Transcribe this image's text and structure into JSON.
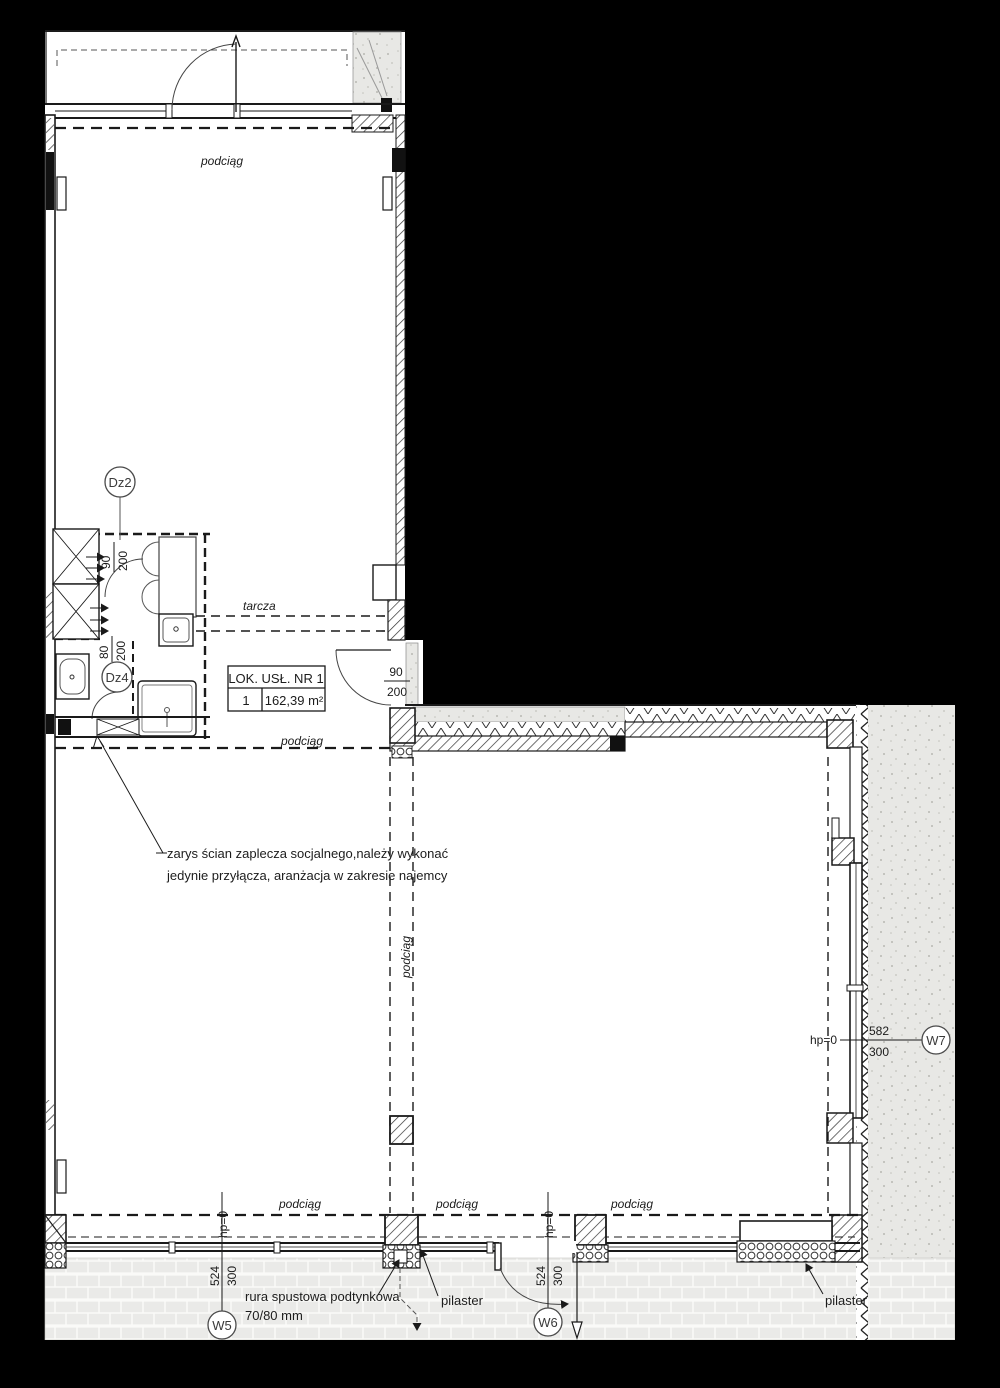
{
  "labels": {
    "podciag": "podciąg",
    "tarcza": "tarcza"
  },
  "room_table": {
    "title": "LOK. USŁ. NR 1",
    "index": "1",
    "area": "162,39 m²"
  },
  "markers": {
    "dz2": "Dz2",
    "dz4": "Dz4",
    "w5": "W5",
    "w6": "W6",
    "w7": "W7"
  },
  "dims": {
    "d90": "90",
    "d200": "200",
    "d80": "80",
    "hp0": "hp=0",
    "v524": "524",
    "v300": "300",
    "v582": "582"
  },
  "notes": {
    "outline1": "zarys ścian zaplecza socjalnego,należy wykonać",
    "outline2": "jedynie przyłącza, aranżacja w zakresie najemcy",
    "pipe1": "rura spustowa podtynkowa",
    "pipe2": "70/80 mm",
    "pilaster": "pilaster"
  },
  "colors": {
    "background": "#000000",
    "paper": "#ffffff",
    "line": "#1a1a1a",
    "terrain": "#e8e8e5",
    "paving": "#eaeae8"
  }
}
